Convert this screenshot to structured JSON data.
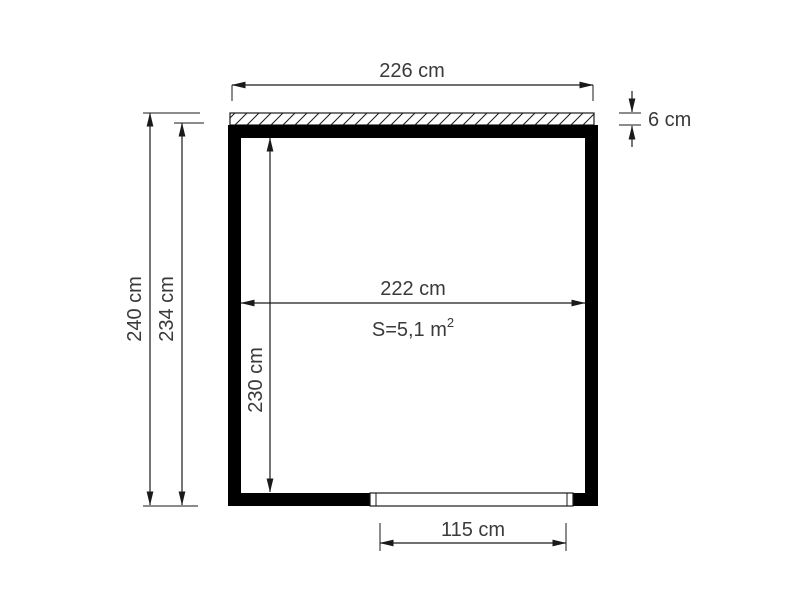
{
  "colors": {
    "background": "#ffffff",
    "line": "#1a1a1a",
    "wall_fill": "#000000",
    "text": "#3a3a3a"
  },
  "floor_plan": {
    "description_visible_labels_only": "dimension drawing of a rectangular structure with roof strip and door opening",
    "dims": {
      "roof_width": "226 cm",
      "roof_thickness": "6 cm",
      "total_height": "240 cm",
      "wall_outer_height": "234 cm",
      "inner_width": "222 cm",
      "inner_height": "230 cm",
      "door_width": "115 cm"
    },
    "area": {
      "prefix": "S=5,1 m",
      "superscript": "2"
    }
  }
}
